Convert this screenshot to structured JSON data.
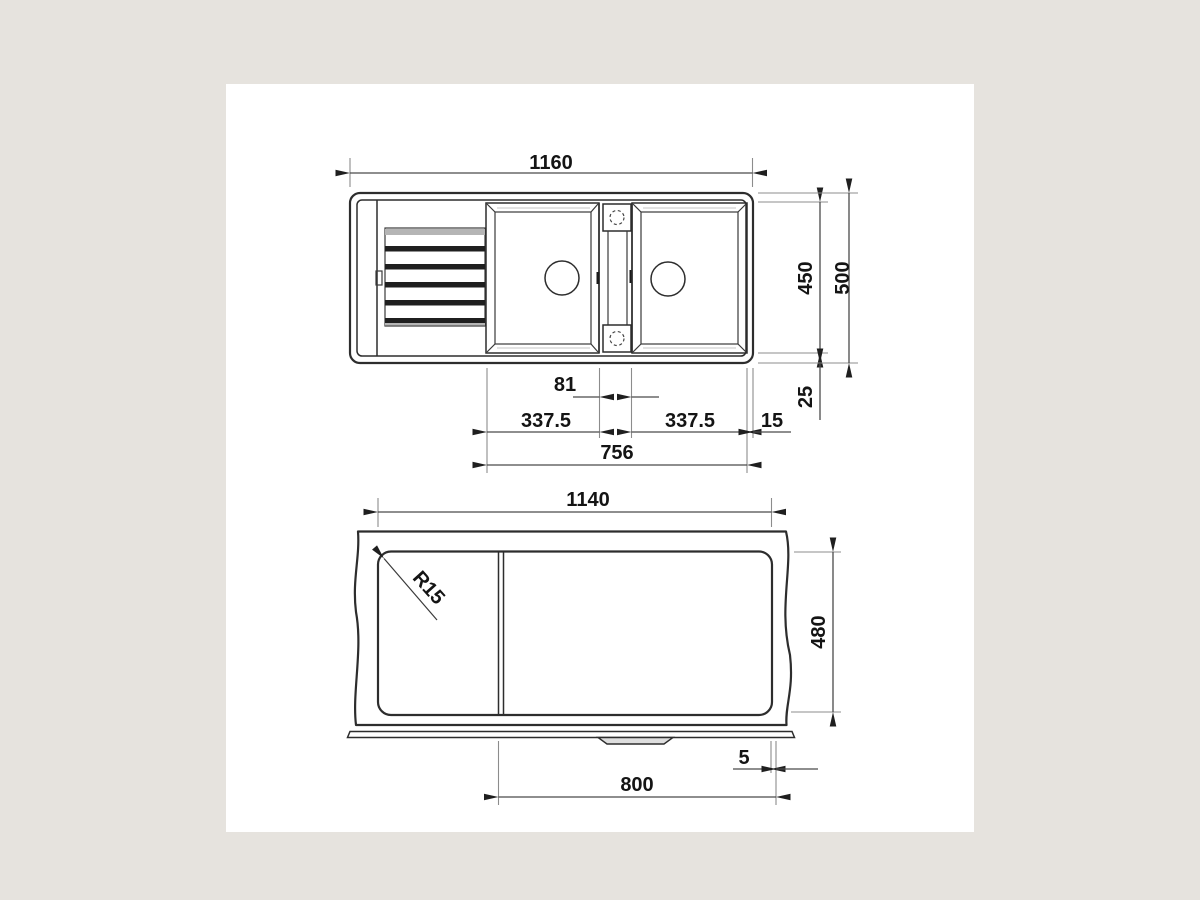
{
  "page": {
    "background_color": "#e6e3de",
    "panel_color": "#ffffff",
    "line_color": "#2d2d2d",
    "text_color": "#141414"
  },
  "top_view": {
    "description": "sink plan view with drainboard, two bowls and center divider",
    "dims": {
      "overall_width": "1160",
      "inner_depth": "450",
      "overall_depth": "500",
      "divider_width": "81",
      "left_bowl_width": "337.5",
      "right_bowl_width": "337.5",
      "rim_width": "15",
      "rim_offset": "25",
      "bowls_span": "756"
    }
  },
  "cutout_view": {
    "description": "countertop cutout view with break lines",
    "dims": {
      "cutout_width": "1140",
      "corner_radius": "R15",
      "cutout_depth": "480",
      "edge_gap": "5",
      "cutout_span": "800"
    }
  }
}
